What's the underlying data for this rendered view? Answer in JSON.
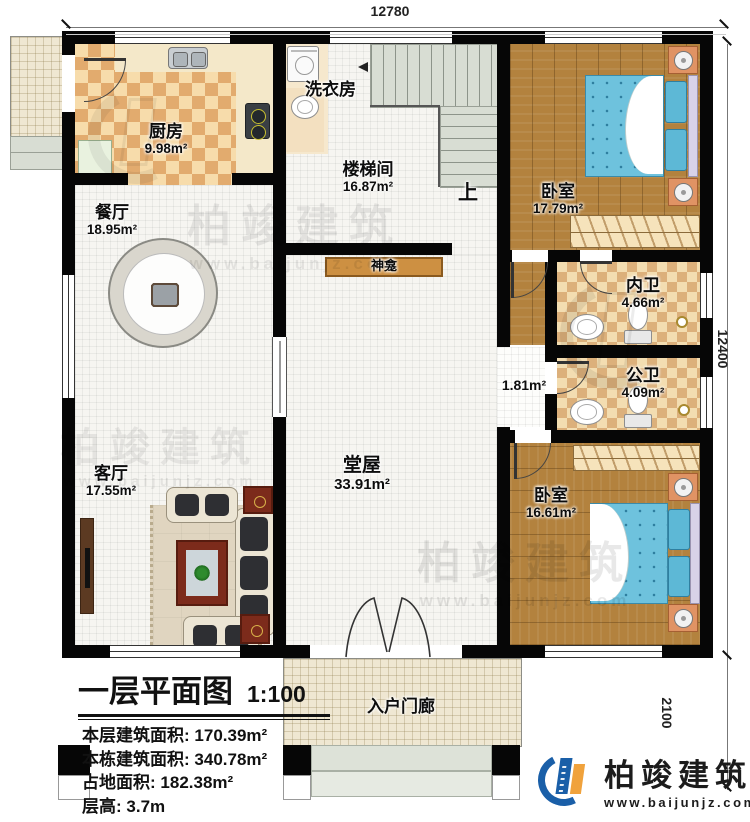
{
  "dimensions": {
    "top_width": "12780",
    "right_height": "12400",
    "porch_depth": "2100"
  },
  "rooms": {
    "kitchen": {
      "name": "厨房",
      "area": "9.98m²"
    },
    "laundry": {
      "name": "洗衣房"
    },
    "stairwell": {
      "name": "楼梯间",
      "area": "16.87m²"
    },
    "stairs_up": "上",
    "bedroom1": {
      "name": "卧室",
      "area": "17.79m²"
    },
    "dining": {
      "name": "餐厅",
      "area": "18.95m²"
    },
    "shrine": {
      "name": "神龛"
    },
    "ensuite_bath": {
      "name": "内卫",
      "area": "4.66m²"
    },
    "public_bath": {
      "name": "公卫",
      "area": "4.09m²"
    },
    "hallway": {
      "area": "1.81m²"
    },
    "living": {
      "name": "客厅",
      "area": "17.55m²"
    },
    "main_hall": {
      "name": "堂屋",
      "area": "33.91m²"
    },
    "bedroom2": {
      "name": "卧室",
      "area": "16.61m²"
    },
    "porch": {
      "name": "入户门廊"
    }
  },
  "legend": {
    "title": "一层平面图",
    "scale": "1:100",
    "stats": [
      {
        "label": "本层建筑面积:",
        "value": "170.39m²"
      },
      {
        "label": "本栋建筑面积:",
        "value": "340.78m²"
      },
      {
        "label": "占地面积:",
        "value": "182.38m²"
      },
      {
        "label": "层高:",
        "value": "3.7m"
      }
    ]
  },
  "branding": {
    "company": "柏竣建筑",
    "website": "www.baijunjz.com",
    "logo_blue": "#1a5fa8",
    "logo_orange": "#f0a23c"
  },
  "watermark": {
    "company": "柏竣建筑",
    "website": "www.baijunjz.com"
  }
}
